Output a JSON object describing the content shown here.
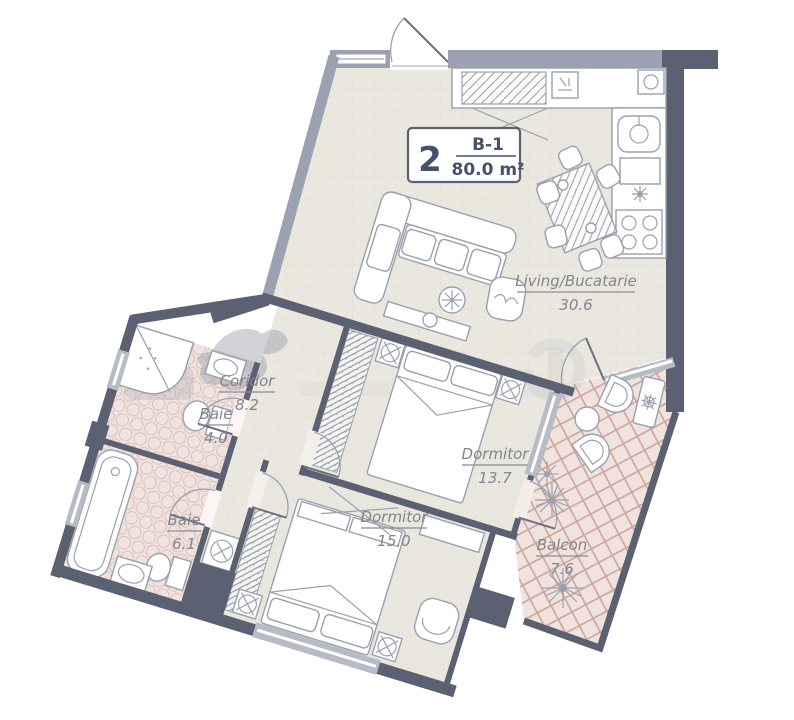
{
  "plan": {
    "badge": {
      "unit_number": "2",
      "unit_type": "B-1",
      "area_label": "80.0 m²"
    },
    "rooms": [
      {
        "id": "living",
        "name": "Living/Bucatarie",
        "area": "30.6"
      },
      {
        "id": "coridor",
        "name": "Coridor",
        "area": "8.2"
      },
      {
        "id": "baie-mica",
        "name": "Baie",
        "area": "4.0"
      },
      {
        "id": "baie-mare",
        "name": "Baie",
        "area": "6.1"
      },
      {
        "id": "dormitor1",
        "name": "Dormitor",
        "area": "13.7"
      },
      {
        "id": "dormitor2",
        "name": "Dormitor",
        "area": "15.0"
      },
      {
        "id": "balcon",
        "name": "Balcon",
        "area": "7.6"
      }
    ],
    "colors": {
      "wall_dark": "#5b6173",
      "wall_light": "#9ba1b1",
      "floor_living": "#eae7de",
      "floor_bedroom": "#e9e7dd",
      "floor_bath": "#f0e3df",
      "bath_tile_accent": "#ddbfb9",
      "balcony_tile": "#f0e2dc",
      "balcony_lattice": "#cba59e",
      "label_text": "#84848e",
      "badge_text": "#46516b",
      "furniture_line": "#9aa0ad"
    }
  }
}
